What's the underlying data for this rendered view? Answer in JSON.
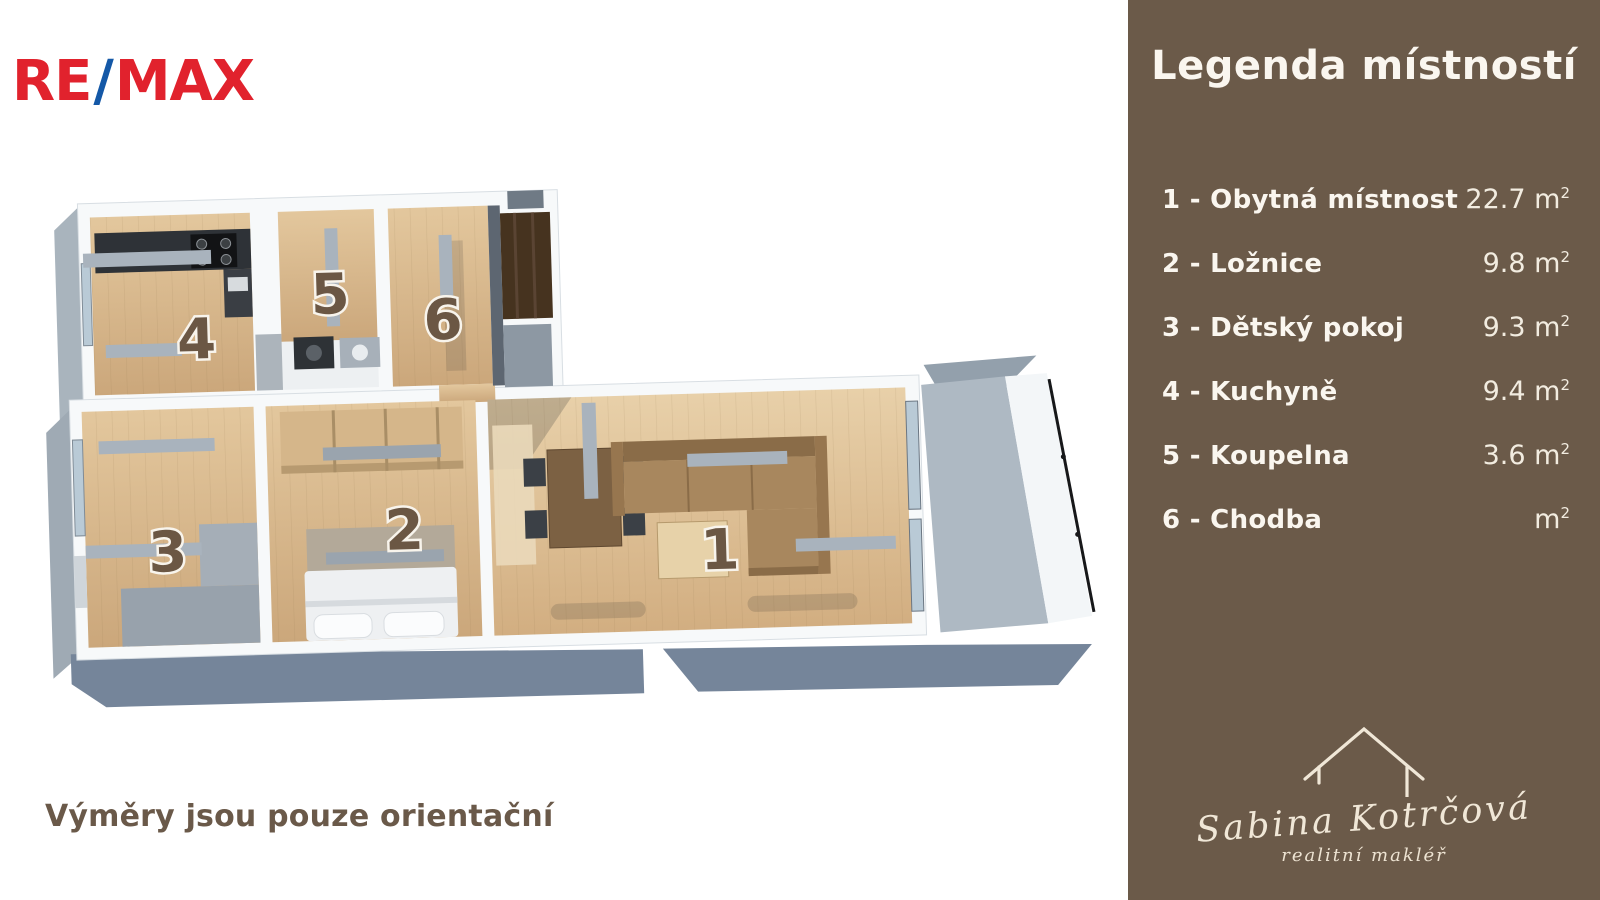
{
  "logo": {
    "re": "RE",
    "slash": "/",
    "max": "MAX",
    "color_red": "#E1222D",
    "color_blue": "#1458A7"
  },
  "sidebar": {
    "background": "#6B5A49",
    "title": "Legenda místností",
    "items": [
      {
        "label": "1 - Obytná místnost",
        "area": "22.7",
        "unit": "m",
        "sup": "2"
      },
      {
        "label": "2 - Ložnice",
        "area": "9.8",
        "unit": "m",
        "sup": "2"
      },
      {
        "label": "3 - Dětský pokoj",
        "area": "9.3",
        "unit": "m",
        "sup": "2"
      },
      {
        "label": "4 - Kuchyně",
        "area": "9.4",
        "unit": "m",
        "sup": "2"
      },
      {
        "label": "5 - Koupelna",
        "area": "3.6",
        "unit": "m",
        "sup": "2"
      },
      {
        "label": "6 - Chodba",
        "area": "",
        "unit": "m",
        "sup": "2"
      }
    ],
    "signature": {
      "name": "Sabina Kotrčová",
      "role": "realitní makléř",
      "icon": "house-outline-icon"
    }
  },
  "floorplan": {
    "note": "Výměry jsou pouze orientační",
    "room_labels": [
      "1",
      "2",
      "3",
      "4",
      "5",
      "6"
    ]
  }
}
